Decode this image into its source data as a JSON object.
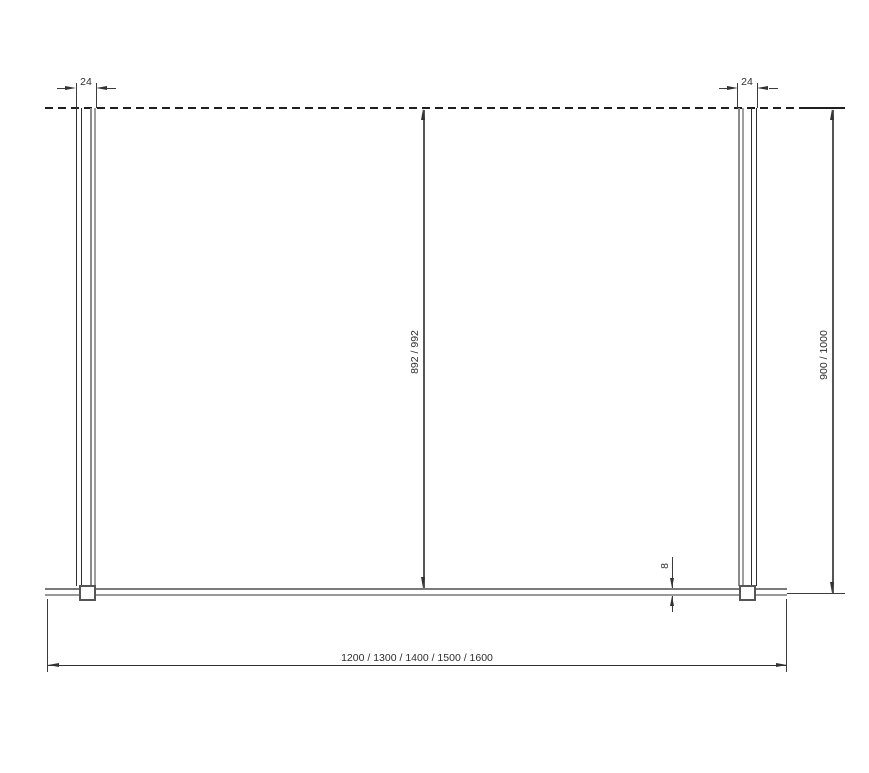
{
  "drawing": {
    "dimensions": {
      "left_profile_width": "24",
      "right_profile_width": "24",
      "glass_height": "892 / 992",
      "overall_height": "900 / 1000",
      "bottom_profile_thickness": "8",
      "overall_width": "1200 / 1300 / 1400 / 1500 / 1600"
    },
    "colors": {
      "background": "#ffffff",
      "outline": "#2f2f2f",
      "profile_gray": "#8f8f8f",
      "dimension_line": "#3c3c3c"
    }
  }
}
